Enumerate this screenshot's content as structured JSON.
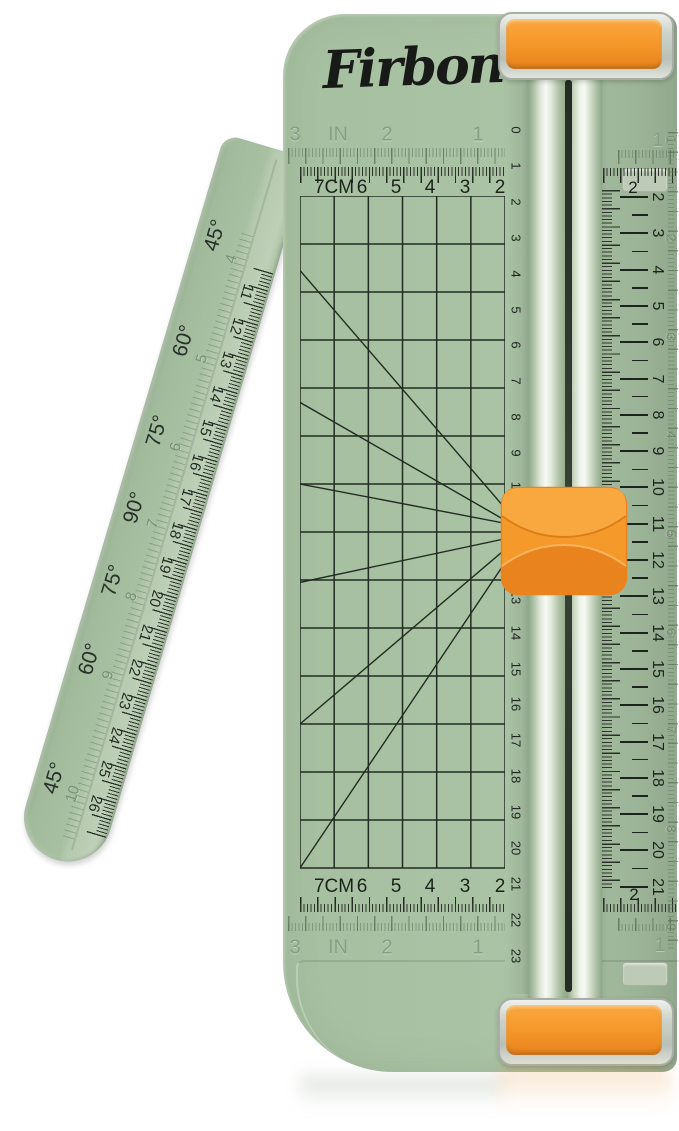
{
  "product": {
    "brand_logo": "Firbon",
    "kind": "paper trimmer"
  },
  "colors": {
    "body_green": "#a9c2a3",
    "arm_green": "#a3bb9e",
    "orange": "#f6992b",
    "orange_light": "#f9a840",
    "orange_dark": "#e8831d",
    "print_black": "#1c221c",
    "embossed_green": "#879e84",
    "slot_dark": "#2d352c",
    "clear_plastic": "#d9ded6"
  },
  "scales": {
    "inch_row": {
      "labels": [
        "3",
        "IN",
        "2",
        "1"
      ],
      "right_segment_label": "1"
    },
    "cm_row": {
      "labels": [
        "7CM",
        "6",
        "5",
        "4",
        "3",
        "2"
      ],
      "right_segment_label": "2"
    },
    "rail_left_scale": {
      "start": 0,
      "end": 23
    },
    "right_cm_scale": {
      "start": 2,
      "end": 21
    },
    "right_inch_scale": {
      "start": 1,
      "end": 9
    }
  },
  "grid": {
    "columns": 6,
    "rows": 14,
    "diagonals": [
      [
        0,
        1.55,
        6.6,
        7.0
      ],
      [
        0,
        4.3,
        6.6,
        7.0
      ],
      [
        0,
        6.0,
        6.6,
        6.9
      ],
      [
        0,
        8.05,
        6.6,
        7.05
      ],
      [
        0,
        11.0,
        6.6,
        7.0
      ],
      [
        0,
        14.0,
        6.6,
        7.0
      ]
    ]
  },
  "arm": {
    "angle_labels": [
      "45°",
      "60°",
      "75°",
      "90°",
      "75°",
      "60°",
      "45°"
    ],
    "embossed_numbers": [
      4,
      5,
      6,
      7,
      8,
      9,
      10
    ],
    "ruler_numbers": {
      "start": 11,
      "end": 26
    }
  }
}
